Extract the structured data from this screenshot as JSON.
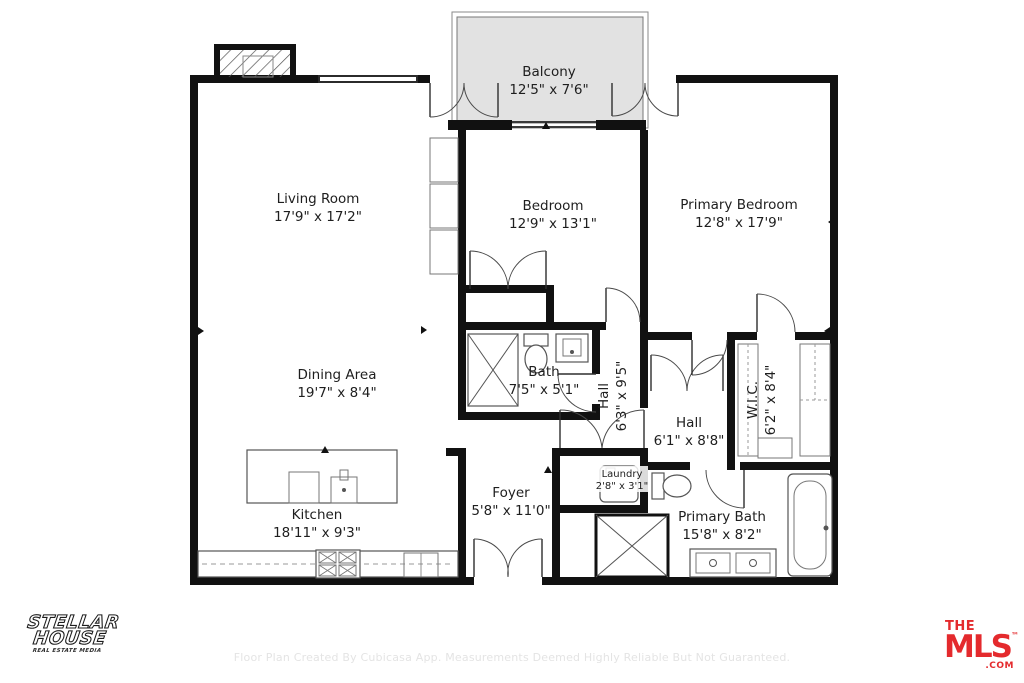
{
  "rooms": {
    "balcony": {
      "name": "Balcony",
      "dims": "12'5\" x 7'6\""
    },
    "living": {
      "name": "Living Room",
      "dims": "17'9\" x 17'2\""
    },
    "bedroom": {
      "name": "Bedroom",
      "dims": "12'9\" x 13'1\""
    },
    "primary_bedroom": {
      "name": "Primary Bedroom",
      "dims": "12'8\" x 17'9\""
    },
    "dining": {
      "name": "Dining Area",
      "dims": "19'7\" x 8'4\""
    },
    "bath": {
      "name": "Bath",
      "dims": "7'5\" x 5'1\""
    },
    "hall1": {
      "name": "Hall",
      "dims": "6'3\" x 9'5\""
    },
    "hall2": {
      "name": "Hall",
      "dims": "6'1\" x 8'8\""
    },
    "wic": {
      "name": "W.I.C.",
      "dims": "6'2\" x 8'4\""
    },
    "kitchen": {
      "name": "Kitchen",
      "dims": "18'11\" x 9'3\""
    },
    "foyer": {
      "name": "Foyer",
      "dims": "5'8\" x 11'0\""
    },
    "laundry": {
      "name": "Laundry",
      "dims": "2'8\" x 3'1\""
    },
    "primary_bath": {
      "name": "Primary Bath",
      "dims": "15'8\" x 8'2\""
    }
  },
  "branding": {
    "stellar_house": {
      "line1": "STELLAR",
      "line2": "HOUSE",
      "tagline": "REAL ESTATE MEDIA"
    },
    "the_mls": {
      "the": "THE",
      "mls": "MLS",
      "trademark": "™",
      "suffix": ".COM",
      "brand_color": "#e42a2d"
    }
  },
  "footer": {
    "disclaimer": "Floor Plan Created By Cubicasa App. Measurements Deemed Highly Reliable But Not Guaranteed."
  },
  "colors": {
    "walls": "#111111",
    "balcony_fill": "#e2e2e2",
    "faint_text": "#e4e4e4"
  }
}
